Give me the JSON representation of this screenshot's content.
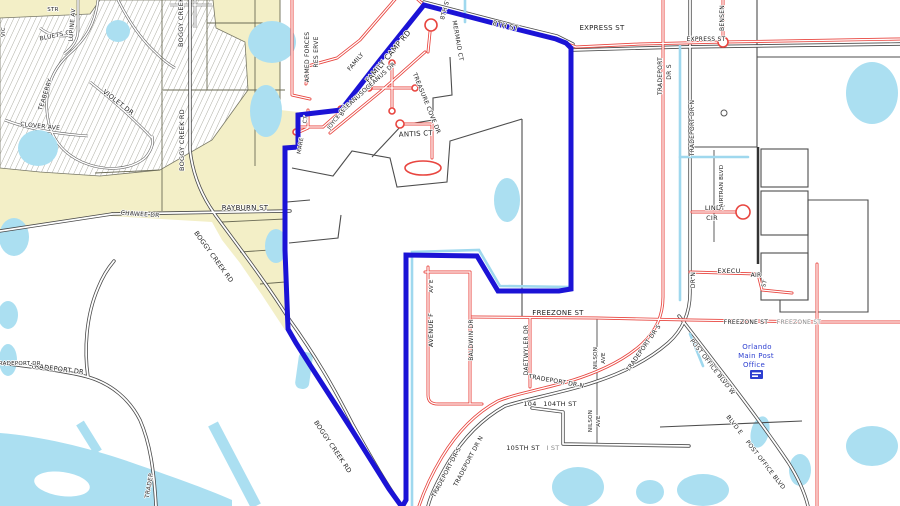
{
  "map": {
    "kind": "parcel-street-map",
    "boundary": "blue study-area polygon",
    "colors": {
      "boundary_blue": "#1b13d6",
      "water": "#abdff1",
      "parcel_fill": "#f3efc7",
      "road_red": "#e8453f",
      "road_casing": "#4a4a4a",
      "label_text": "#1f1f1f",
      "post_office_blue": "#2d3fd0"
    }
  },
  "streets": {
    "boggy_creek_rd": "BOGGY CREEK RD",
    "rayburn_st": "RAYBURN ST",
    "chawee_dr": "CHAWEE DR",
    "bluets_ct": "BLUETS CT",
    "lupine_av": "LUPINE AV",
    "teaberry": "TEABERRY",
    "violet_dr": "VIOLET DR",
    "clover_ave": "CLOVER AVE",
    "str": "STR",
    "vic": "VIC",
    "family": "FAMILY",
    "family_camp_rd": "FAMILY CAMP RD",
    "armed_forces": "ARMED FORCES",
    "reserve": "RES ERVE",
    "oceanus_dr": "OCEANUS DR",
    "mermaid_ct": "MERMAID CT",
    "treasure_cove_dr": "TREASURE COVE DR",
    "antis_ct": "ANTIS CT",
    "ct": "CT",
    "mare": "MARE",
    "joyce": "JOYCE",
    "bey": "BEY",
    "eighth_st": "8TH ST",
    "express_st": "EXPRESS ST",
    "bensen": "BENSEN",
    "tradeport": "TRADEPORT",
    "dr_s": "DR S",
    "dr_n": "DR N",
    "tradeport_dr": "TRADEPORT DR",
    "tradeport_dr_s": "TRADEPORT DR S",
    "tradeport_dr_n": "TRADEPORT DR N",
    "tradep": "TRADEP",
    "lindy": "LINDY",
    "cir": "CIR",
    "airtran_blvd": "AIRTRAN BLVD",
    "execu": "EXECU",
    "air": "AIR",
    "st": "ST",
    "freezone_st": "FREEZONE ST",
    "daetwyler_dr": "DAETWYLER DR",
    "nilson": "NILSON",
    "ave": "AVE",
    "avenue_f": "AVENUE F",
    "av_e": "AV E",
    "baldwin_dr": "BALDWIN DR",
    "n104": "104",
    "st104": "104TH ST",
    "st105": "105TH ST",
    "i_st": "I ST",
    "post_office_blvd_w": "POST OFFICE BLVD W",
    "blvd_e": "BLVD E",
    "post_office_blvd": "POST OFFICE BLVD"
  },
  "poi": {
    "post_office": {
      "line1": "Orlando",
      "line2": "Main Post",
      "line3": "Office"
    }
  }
}
